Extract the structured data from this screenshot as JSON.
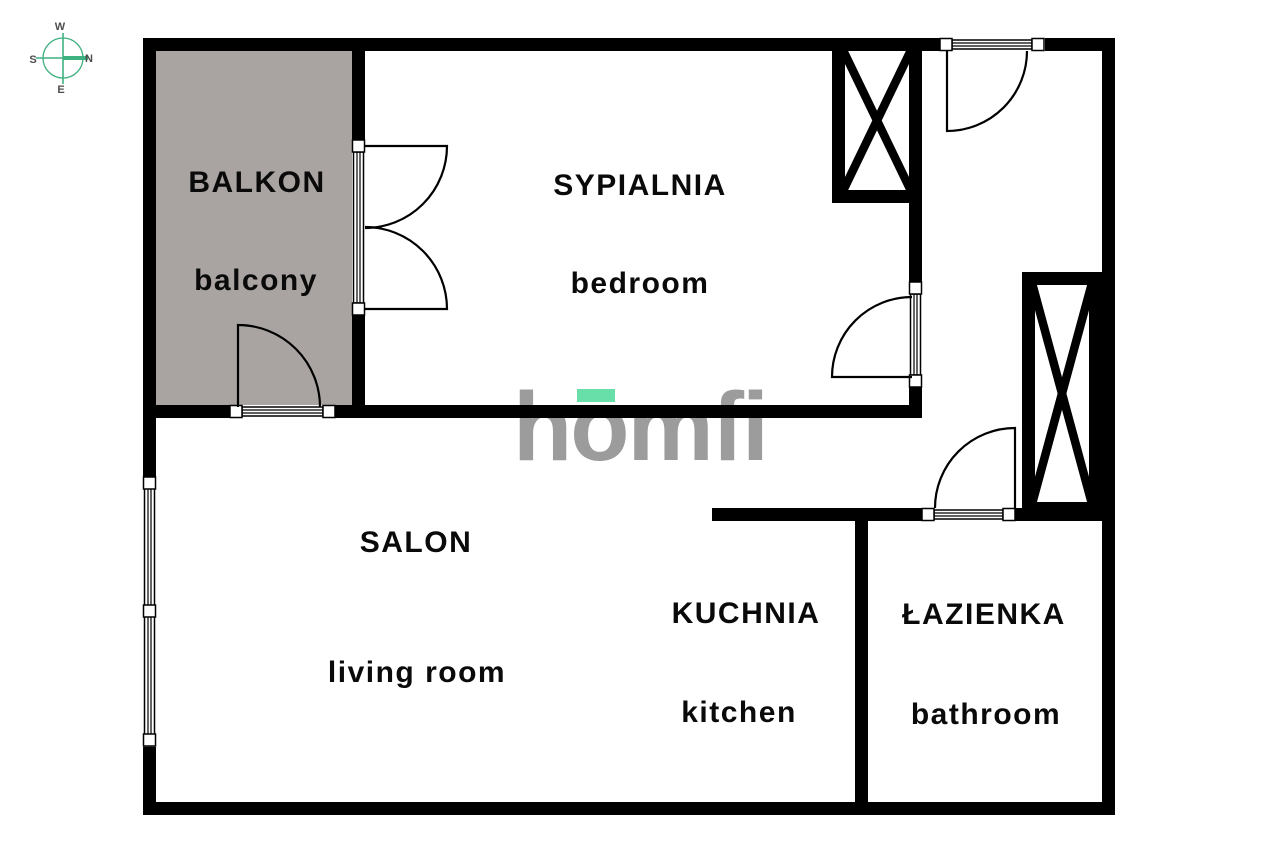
{
  "rooms": {
    "balcony": {
      "name_pl": "BALKON",
      "name_en": "balcony"
    },
    "bedroom": {
      "name_pl": "SYPIALNIA",
      "name_en": "bedroom"
    },
    "living_room": {
      "name_pl": "SALON",
      "name_en": "living room"
    },
    "kitchen": {
      "name_pl": "KUCHNIA",
      "name_en": "kitchen"
    },
    "bathroom": {
      "name_pl": "ŁAZIENKA",
      "name_en": "bathroom"
    }
  },
  "compass": {
    "top_label": "W",
    "left_label": "S",
    "right_label": "N",
    "bottom_label": "E"
  },
  "logo": {
    "text": "homfi"
  },
  "colors": {
    "wall_black": "#000000",
    "balcony_floor_gray": "#a9a4a2",
    "label_text": "#0a0a0a",
    "logo_gray": "#9c9c9c",
    "logo_accent_green": "#68dfa9",
    "compass_green": "#3fb080",
    "compass_label_gray": "#4d4d4d",
    "background": "#ffffff"
  }
}
